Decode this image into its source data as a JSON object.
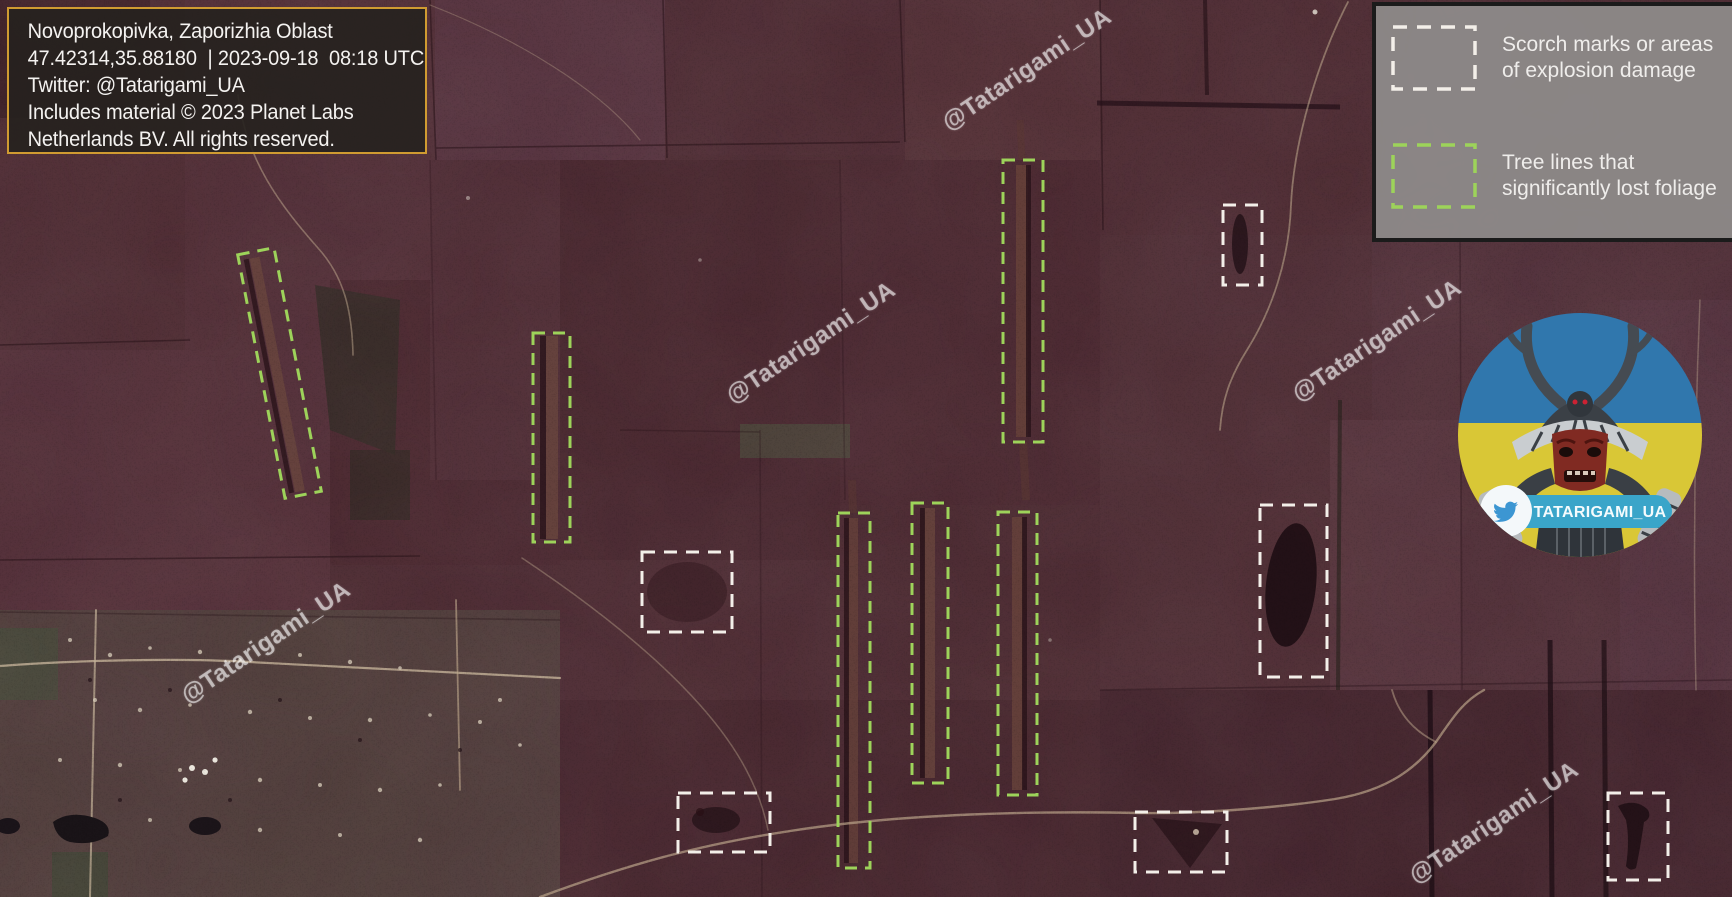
{
  "info_box": {
    "lines": [
      "Novoprokopivka, Zaporizhia Oblast",
      "47.42314,35.88180  | 2023-09-18  08:18 UTC",
      "Twitter: @Tatarigami_UA",
      "Includes material © 2023 Planet Labs",
      "Netherlands BV. All rights reserved."
    ]
  },
  "legend": {
    "items": [
      {
        "id": "scorch",
        "swatch_color": "#f3efe9",
        "lines": [
          "Scorch marks or areas",
          "of explosion damage"
        ]
      },
      {
        "id": "treeline",
        "swatch_color": "#9dd35a",
        "lines": [
          "Tree lines that",
          "significantly lost foliage"
        ]
      }
    ]
  },
  "watermark": {
    "text": "@Tatarigami_UA",
    "rotation_deg": -34,
    "positions": [
      {
        "x": 1023,
        "y": 74
      },
      {
        "x": 807,
        "y": 347
      },
      {
        "x": 1373,
        "y": 345
      },
      {
        "x": 262,
        "y": 647
      },
      {
        "x": 1490,
        "y": 827
      }
    ]
  },
  "avatar": {
    "handle": "TATARIGAMI_UA",
    "flag_blue": "#3077ad",
    "flag_yellow": "#d9c736",
    "pill_color": "#3aa5c9"
  },
  "annotations": {
    "scorch_color": "#f3efe9",
    "treeline_color": "#9dd35a",
    "scorch_boxes": [
      {
        "x": 1223,
        "y": 205,
        "w": 39,
        "h": 80
      },
      {
        "x": 642,
        "y": 552,
        "w": 90,
        "h": 80
      },
      {
        "x": 1260,
        "y": 505,
        "w": 67,
        "h": 172
      },
      {
        "x": 678,
        "y": 793,
        "w": 92,
        "h": 59
      },
      {
        "x": 1135,
        "y": 812,
        "w": 92,
        "h": 60
      },
      {
        "x": 1608,
        "y": 793,
        "w": 60,
        "h": 87
      }
    ],
    "treeline_boxes": [
      {
        "x": 261,
        "y": 249,
        "w": 37,
        "h": 248,
        "rotate": -11
      },
      {
        "x": 533,
        "y": 333,
        "w": 37,
        "h": 209,
        "rotate": 0
      },
      {
        "x": 1003,
        "y": 160,
        "w": 40,
        "h": 282,
        "rotate": 0
      },
      {
        "x": 838,
        "y": 513,
        "w": 32,
        "h": 355,
        "rotate": 0
      },
      {
        "x": 912,
        "y": 503,
        "w": 36,
        "h": 280,
        "rotate": 0
      },
      {
        "x": 998,
        "y": 512,
        "w": 39,
        "h": 283,
        "rotate": 0
      }
    ]
  }
}
